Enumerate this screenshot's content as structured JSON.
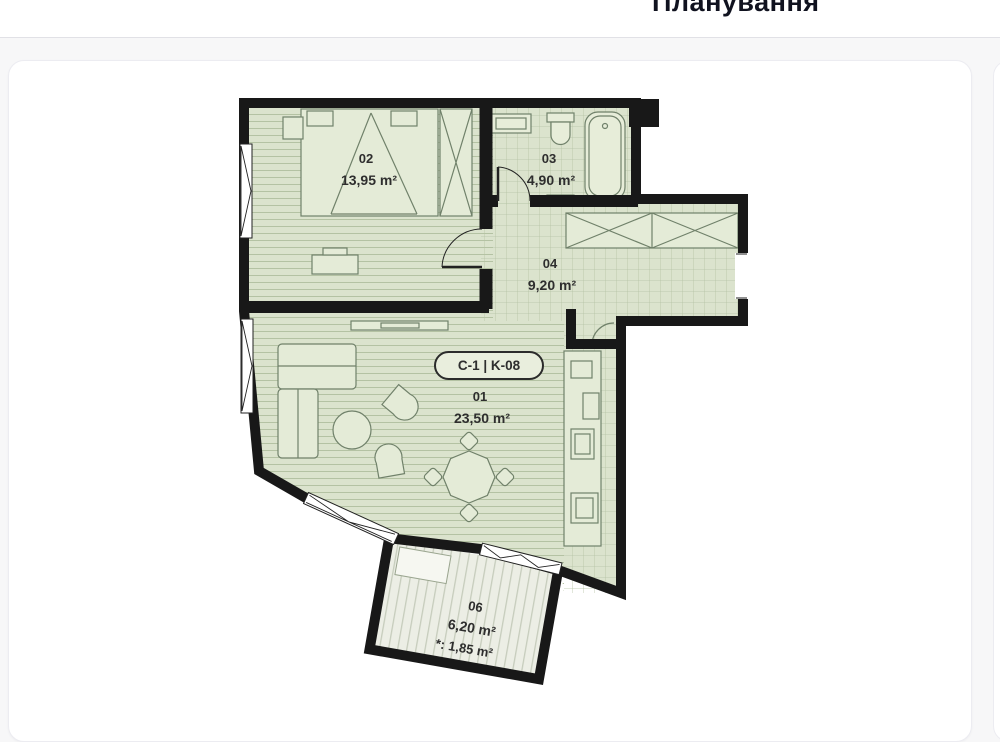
{
  "page": {
    "title": "Планування"
  },
  "plan": {
    "unit_label": "C-1 | K-08",
    "rooms": [
      {
        "id": "02",
        "area": "13,95 m²"
      },
      {
        "id": "03",
        "area": "4,90 m²"
      },
      {
        "id": "04",
        "area": "9,20 m²"
      },
      {
        "id": "01",
        "area": "23,50 m²"
      },
      {
        "id": "06",
        "area": "6,20 m²",
        "area_note": "*: 1,85 m²"
      }
    ],
    "colors": {
      "wall": "#181818",
      "floor": "#dbe3cd",
      "floor_line": "#b4c2a3",
      "balcony_floor": "#eceee5",
      "balcony_stripe": "#c6ccbc",
      "furniture_fill": "#e4ebd7",
      "furniture_line": "#70816a"
    }
  }
}
